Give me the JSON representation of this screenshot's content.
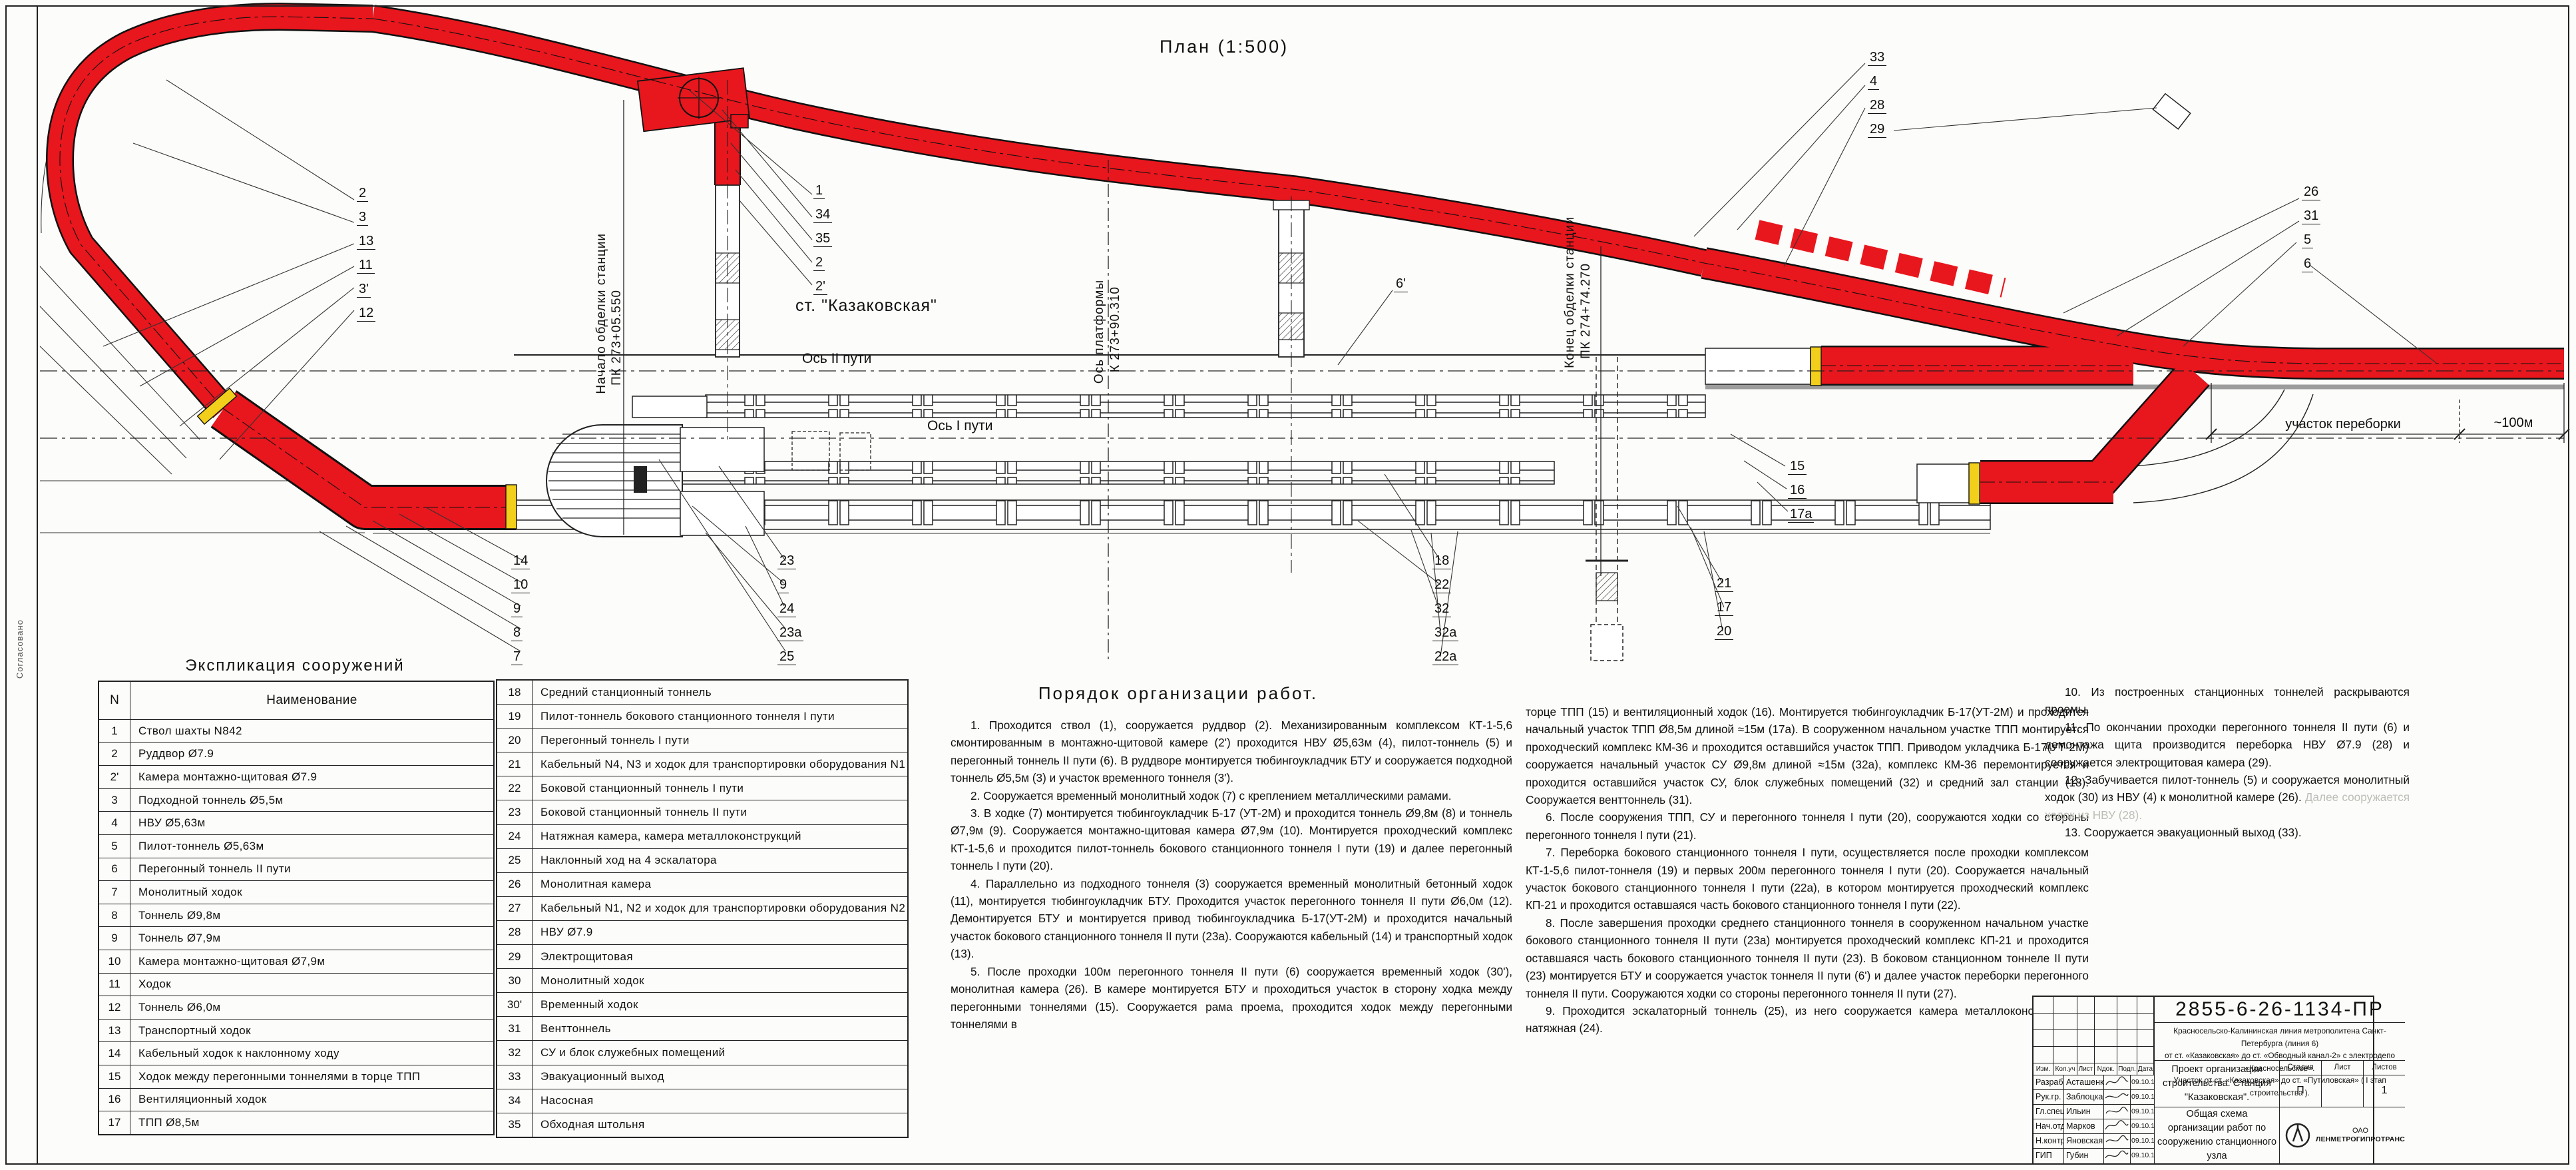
{
  "colors": {
    "tunnel_red": "#e8161d",
    "marker_yellow": "#f2cf1a",
    "line": "#1a1a1a"
  },
  "plan": {
    "title": "План  (1:500)",
    "station": "ст. \"Казаковская\"",
    "axis2": "Ось II пути",
    "axis1": "Ось I пути",
    "lining_start": [
      "Начало обделки станции",
      "ПК 273+05.550"
    ],
    "platform_axis": [
      "Ось платформы",
      "К 273+90.310"
    ],
    "lining_end": [
      "Конец обделки станции",
      "ПК 274+74.270"
    ],
    "rework_label": "участок переборки",
    "rework_length": "~100м",
    "margin_note": "Согласовано",
    "callouts": {
      "shaft": [
        "1",
        "34",
        "35",
        "2",
        "2'"
      ],
      "left": [
        "2",
        "3",
        "13",
        "11",
        "3'",
        "12"
      ],
      "top_right": [
        "33",
        "4",
        "28",
        "29"
      ],
      "right": [
        "26",
        "31",
        "5",
        "6"
      ],
      "bottom_a": [
        "14",
        "10",
        "9",
        "8",
        "7"
      ],
      "bottom_b": [
        "23",
        "9",
        "24",
        "23а",
        "25"
      ],
      "bottom_c": [
        "18",
        "22",
        "32",
        "32а",
        "22а"
      ],
      "bottom_d": [
        "21",
        "17",
        "20"
      ],
      "mid_right": [
        "15",
        "16",
        "17а"
      ],
      "single": [
        "6'"
      ]
    }
  },
  "explication": {
    "title": "Экспликация сооружений",
    "col_num": "N",
    "col_name": "Наименование",
    "rows1": [
      [
        "1",
        "Ствол шахты N842"
      ],
      [
        "2",
        "Руддвор Ø7.9"
      ],
      [
        "2'",
        "Камера монтажно-щитовая Ø7.9"
      ],
      [
        "3",
        "Подходной тоннель Ø5,5м"
      ],
      [
        "4",
        "НВУ Ø5,63м"
      ],
      [
        "5",
        "Пилот-тоннель Ø5,63м"
      ],
      [
        "6",
        "Перегонный тоннель II пути"
      ],
      [
        "7",
        "Монолитный ходок"
      ],
      [
        "8",
        "Тоннель Ø9,8м"
      ],
      [
        "9",
        "Тоннель Ø7,9м"
      ],
      [
        "10",
        "Камера монтажно-щитовая Ø7,9м"
      ],
      [
        "11",
        "Ходок"
      ],
      [
        "12",
        "Тоннель Ø6,0м"
      ],
      [
        "13",
        "Транспортный ходок"
      ],
      [
        "14",
        "Кабельный ходок к наклонному ходу"
      ],
      [
        "15",
        "Ходок между перегонными тоннелями в торце ТПП"
      ],
      [
        "16",
        "Вентиляционный ходок"
      ],
      [
        "17",
        "ТПП Ø8,5м"
      ]
    ],
    "rows2": [
      [
        "18",
        "Средний станционный тоннель"
      ],
      [
        "19",
        "Пилот-тоннель бокового станционного тоннеля I пути"
      ],
      [
        "20",
        "Перегонный тоннель I пути"
      ],
      [
        "21",
        "Кабельный N4, N3 и ходок для транспортировки оборудования N1"
      ],
      [
        "22",
        "Боковой станционный тоннель I пути"
      ],
      [
        "23",
        "Боковой станционный тоннель II пути"
      ],
      [
        "24",
        "Натяжная камера, камера металлоконструкций"
      ],
      [
        "25",
        "Наклонный ход на 4 эскалатора"
      ],
      [
        "26",
        "Монолитная камера"
      ],
      [
        "27",
        "Кабельный N1, N2 и ходок для транспортировки оборудования N2"
      ],
      [
        "28",
        "НВУ Ø7.9"
      ],
      [
        "29",
        "Электрощитовая"
      ],
      [
        "30",
        "Монолитный ходок"
      ],
      [
        "30'",
        "Временный ходок"
      ],
      [
        "31",
        "Венттоннель"
      ],
      [
        "32",
        "СУ и блок служебных помещений"
      ],
      [
        "33",
        "Эвакуационный выход"
      ],
      [
        "34",
        "Насосная"
      ],
      [
        "35",
        "Обходная штольня"
      ]
    ]
  },
  "work_order": {
    "title": "Порядок организации работ.",
    "col1": [
      "1. Проходится ствол (1), сооружается руддвор (2). Механизированным комплексом КТ-1-5,6 смонтированным в монтажно-щитовой камере (2') проходится НВУ Ø5,63м (4), пилот-тоннель (5) и перегонный тоннель II пути (6). В руддворе монтируется тюбингоукладчик БТУ и сооружается подходной тоннель Ø5,5м (3) и участок временного тоннеля (3').",
      "2. Сооружается временный монолитный ходок (7) с креплением металлическими рамами.",
      "3. В ходке (7) монтируется тюбингоукладчик Б-17 (УТ-2М) и проходится тоннель Ø9,8м (8) и тоннель Ø7,9м (9). Сооружается монтажно-щитовая камера Ø7,9м (10). Монтируется проходческий комплекс КТ-1-5,6 и проходится пилот-тоннель бокового станционного тоннеля I пути (19) и далее перегонный тоннель I пути (20).",
      "4. Параллельно из подходного тоннеля (3) сооружается временный монолитный бетонный ходок (11), монтируется тюбингоукладчик БТУ. Проходится участок перегонного тоннеля II пути Ø6,0м (12). Демонтируется БТУ и монтируется привод тюбингоукладчика Б-17(УТ-2М) и проходится начальный участок бокового станционного тоннеля II пути (23а). Сооружаются кабельный (14) и транспортный ходок (13).",
      "5. После проходки 100м перегонного тоннеля II пути (6) сооружается временный ходок (30'), монолитная камера (26). В камере монтируется БТУ и проходиться участок в сторону ходка между перегонными тоннелями (15). Сооружается рама проема, проходится ходок между перегонными тоннелями в"
    ],
    "col2": [
      "торце ТПП (15) и вентиляционный ходок (16). Монтируется тюбингоукладчик Б-17(УТ-2М) и проходится начальный участок ТПП Ø8,5м длиной ≈15м (17а). В сооруженном начальном участке ТПП монтируется проходческий комплекс КМ-36 и проходится оставшийся участок ТПП. Приводом укладчика Б-17(УТ-2М) сооружается начальный участок СУ Ø9,8м длиной ≈15м (32а), комплекс КМ-36 перемонтируется и проходится оставшийся участок СУ, блок служебных помещений (32) и средний зал станции (18). Сооружается венттоннель (31).",
      "6. После сооружения ТПП, СУ и перегонного тоннеля I пути (20), сооружаются ходки со стороны перегонного тоннеля I пути (21).",
      "7. Переборка бокового станционного тоннеля I пути, осуществляется после проходки комплексом КТ-1-5,6 пилот-тоннеля (19) и первых 200м перегонного тоннеля I пути (20). Сооружается начальный участок бокового станционного тоннеля I пути (22а), в котором монтируется проходческий комплекс КП-21 и проходится оставшаяся часть бокового станционного тоннеля I пути (22).",
      "8. После завершения проходки среднего станционного тоннеля в сооруженном начальном участке бокового станционного тоннеля II пути (23а) монтируется проходческий комплекс КП-21 и проходится оставшаяся часть бокового станционного тоннеля II пути (23). В боковом станционном тоннеле II пути (23) монтируется БТУ и сооружается участок тоннеля II пути (6') и далее участок переборки перегонного тоннеля II пути. Сооружаются ходки со стороны перегонного тоннеля II пути (27).",
      "9. Проходится эскалаторный тоннель (25), из него сооружается камера металлоконструкций и натяжная (24)."
    ],
    "col3": [
      "10. Из построенных станционных тоннелей раскрываются проемы.",
      "11. По окончании проходки перегонного тоннеля II пути (6) и демонтажа щита производится переборка НВУ Ø7.9 (28) и сооружается электрощитовая камера (29).",
      "12. Забучивается пилот-тоннель (5) и сооружается монолитный ходок (30) из НВУ (4) к монолитной камере (26).",
      "13. Сооружается эвакуационный выход (33)."
    ],
    "col3_faded": "Далее сооружается ходок из НВУ (28)."
  },
  "title_block": {
    "doc_number": "2855-6-26-1134-ПР",
    "desc_line1": "Красносельско-Калининская линия метрополитена Санкт-Петербурга (линия 6)",
    "desc_line2": "от ст. «Казаковская» до ст. «Обводный канал-2» с электродепо «Красносельское».",
    "desc_line3": "Участок от ст. «Казаковская» до ст. «Путиловская» ( I этап строительства ).",
    "object_title": "Проект организации строительства. Станция \"Казаковская\".",
    "sheet_title": "Общая схема организации работ по сооружению станционного узла",
    "stage_label": "Стадия",
    "sheet_label": "Лист",
    "sheets_label": "Листов",
    "stage": "П",
    "sheet": "",
    "sheets": "1",
    "company_line1": "ОАО",
    "company_line2": "ЛЕНМЕТРОГИПРОТРАНС",
    "header": [
      "Изм.",
      "Кол.уч",
      "Лист",
      "Nдок.",
      "Подп.",
      "Дата"
    ],
    "rows": [
      [
        "Разраб.",
        "Асташенкова",
        "09.10.13"
      ],
      [
        "Рук.гр.",
        "Заблоцкая",
        "09.10.13"
      ],
      [
        "Гл.спец.",
        "Ильин",
        "09.10.13"
      ],
      [
        "Нач.отд.",
        "Марков",
        "09.10.13"
      ],
      [
        "Н.контр.",
        "Яновская",
        "09.10.13"
      ],
      [
        "ГИП",
        "Губин",
        "09.10.13"
      ]
    ]
  }
}
